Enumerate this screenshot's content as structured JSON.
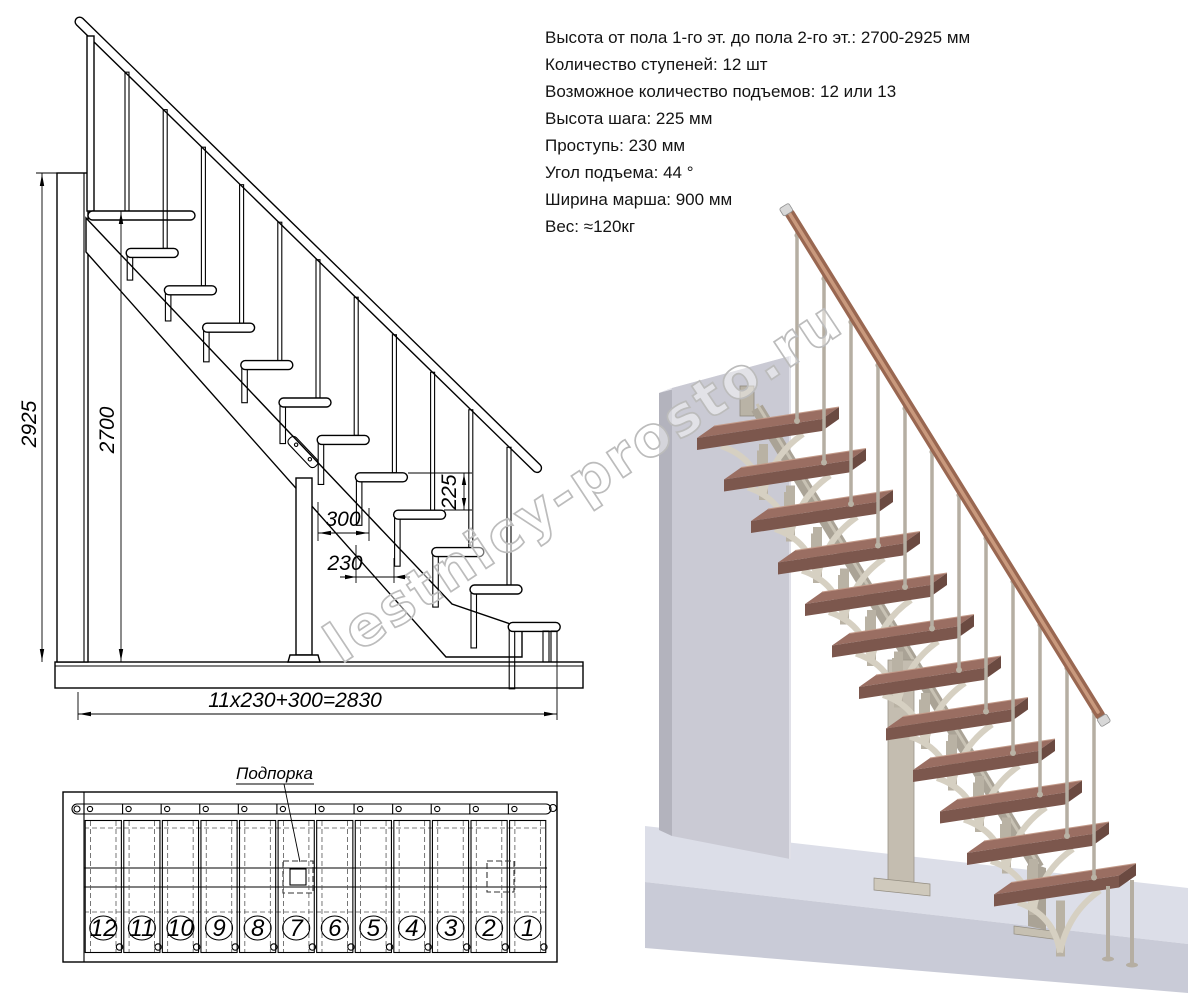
{
  "specs": {
    "lines": [
      "Высота от пола 1-го эт. до пола 2-го эт.: 2700-2925 мм",
      "Количество ступеней: 12 шт",
      "Возможное количество подъемов: 12 или 13",
      "Высота шага: 225 мм",
      "Проступь: 230 мм",
      "Угол подъема: 44 °",
      "Ширина марша: 900 мм",
      "Вес: ≈120кг"
    ]
  },
  "side_view": {
    "dims": {
      "total_height": "2925",
      "floor_height": "2700",
      "riser": "225",
      "tread_depth": "300",
      "run": "230",
      "total_length": "11x230+300=2830"
    }
  },
  "plan_view": {
    "support_label": "Подпорка",
    "step_numbers": [
      "12",
      "11",
      "10",
      "9",
      "8",
      "7",
      "6",
      "5",
      "4",
      "3",
      "2",
      "1"
    ]
  },
  "watermark": {
    "text": "lestnicy-prosto.ru"
  },
  "colors": {
    "step_top": "#9a6e62",
    "step_front": "#7c574d",
    "step_side": "#6b4a41",
    "step_edge": "#c29a89",
    "handrail": "#996751",
    "handrail_light": "#c9997d",
    "metal": "#b5aea2",
    "metal_dark": "#93co8c81",
    "bracket": "#d6d0c2",
    "bracket_stem": "#b9b2a4",
    "stringer": "#aaa396",
    "wall_front": "#cacad4",
    "wall_side": "#b3b3bd",
    "wall_top": "#e6e6ec",
    "floor_top": "#dcdee8",
    "floor_front": "#c9cbd7",
    "watermark": "#bcbcbc",
    "line": "#000000"
  }
}
